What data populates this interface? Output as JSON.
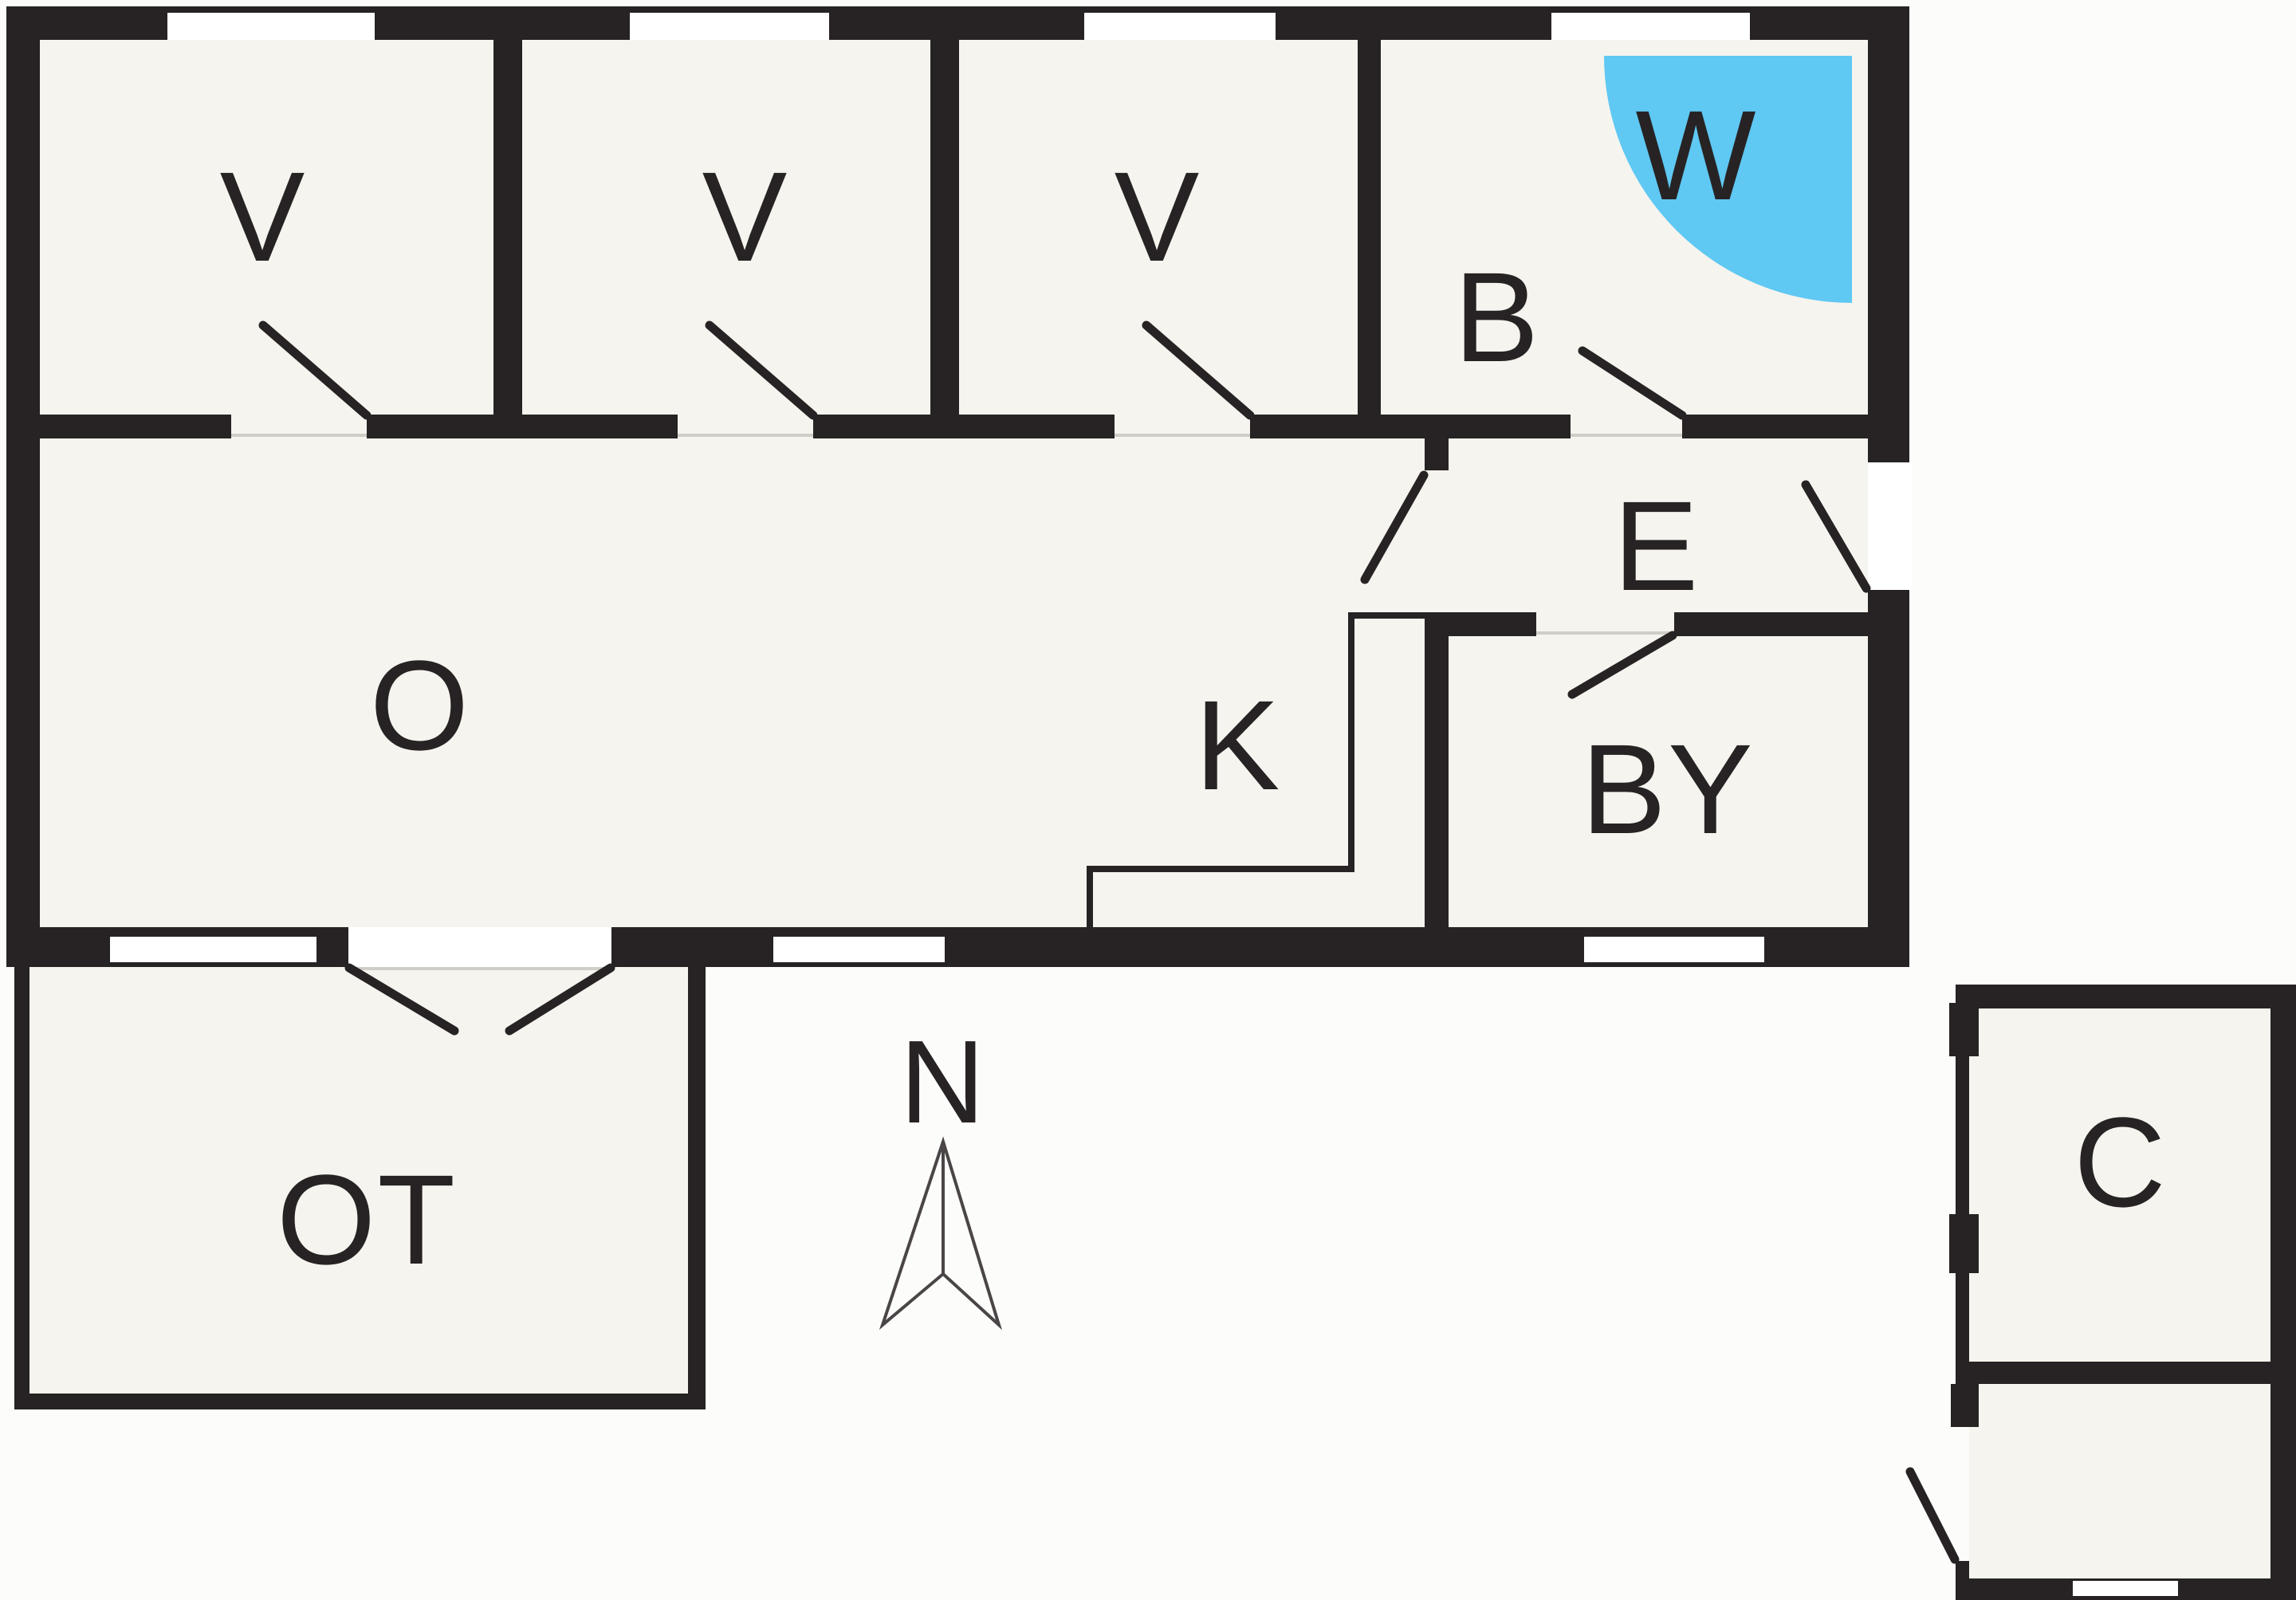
{
  "floor_plan": {
    "room_labels": {
      "v1": "V",
      "v2": "V",
      "v3": "V",
      "b": "B",
      "w": "W",
      "e": "E",
      "k": "K",
      "o": "O",
      "by": "BY",
      "ot": "OT",
      "c": "C"
    },
    "compass": {
      "north_label": "N"
    },
    "colors": {
      "wall": "#272324",
      "water_feature": "#5fc8f3",
      "floor": "#f5f4ee",
      "background": "#fcfcfa",
      "label_text": "#272324"
    }
  }
}
